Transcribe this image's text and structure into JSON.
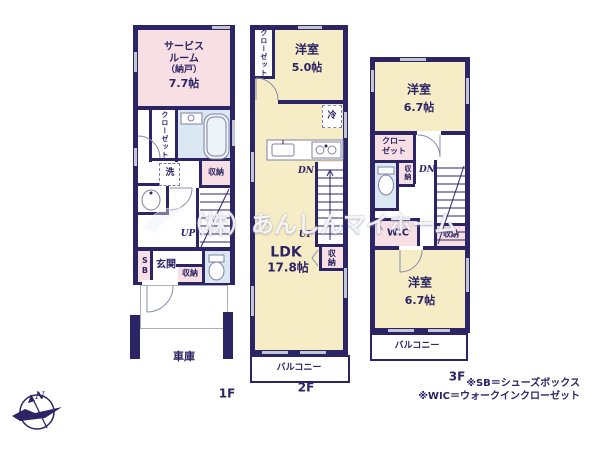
{
  "watermark": {
    "text": "（株）あんしんマイホーム"
  },
  "compass": {
    "north_label": "N"
  },
  "notes": {
    "line1": "※SB＝シューズボックス",
    "line2": "※WIC＝ウォークインクローゼット"
  },
  "floor1": {
    "label": "1F",
    "service_room": {
      "line1": "サービス",
      "line2": "ルーム",
      "line3": "（納戸）",
      "line4": "7.7帖"
    },
    "closet": "クローゼット",
    "laundry": "洗",
    "storage_mid": "収納",
    "up_label": "UP",
    "shoes_box": "SB",
    "entrance": "玄関",
    "storage_entrance": "収納",
    "garage": "車庫"
  },
  "floor2": {
    "label": "2F",
    "closet": "クローゼット",
    "bedroom": {
      "name": "洋室",
      "size": "5.0帖"
    },
    "refrigerator": "冷",
    "down_label": "DN",
    "up_label": "UP",
    "ldk": {
      "name": "LDK",
      "size": "17.8帖"
    },
    "storage": "収納",
    "balcony": "バルコニー"
  },
  "floor3": {
    "label": "3F",
    "bedroom_top": {
      "name": "洋室",
      "size": "6.7帖"
    },
    "closet": {
      "line1": "クロー",
      "line2": "ゼット"
    },
    "storage_hall": "収納",
    "down_label": "DN",
    "wic": "WIC",
    "storage_side": "収納",
    "bedroom_bottom": {
      "name": "洋室",
      "size": "6.7帖"
    },
    "balcony": "バルコニー"
  },
  "colors": {
    "wall": "#2b2465",
    "room_pink": "#f8dfe3",
    "room_cream": "#f6ecc5",
    "room_blue": "#dbe8f4",
    "window_mark": "#c3c6d4",
    "label_text": "#2b2465"
  }
}
